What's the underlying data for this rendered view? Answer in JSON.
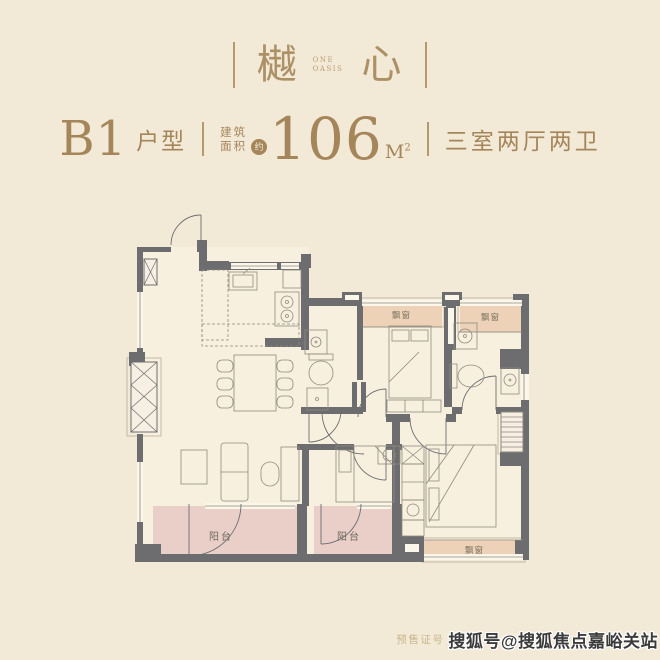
{
  "logo": {
    "char_left": "樾",
    "char_right": "心",
    "subtitle_line1": "ONE",
    "subtitle_line2": "OASIS"
  },
  "header": {
    "unit_code": "B1",
    "unit_type_label": "户型",
    "area_label_line1": "建筑",
    "area_label_line2": "面积",
    "approx_badge": "约",
    "area_value": "106",
    "area_unit": "M",
    "area_unit_exponent": "2",
    "room_summary": "三室两厅两卫"
  },
  "floorplan": {
    "balcony_label_left": "阳台",
    "balcony_label_middle": "阳台",
    "bay_window_label_top_middle": "飘窗",
    "bay_window_label_top_right": "飘窗",
    "bay_window_label_bottom_right": "飘窗"
  },
  "footer": {
    "presale_license_label": "预售证号",
    "watermark": "搜狐号@搜狐焦点嘉峪关站"
  },
  "colors": {
    "page_background": "#f3e9d7",
    "gold_text": "#a5855a",
    "wall_gray": "#6d6d70",
    "balcony_pink": "#eacfc9",
    "bay_window_tan": "#eed2b7",
    "floor_cream": "#f8f0df",
    "watermark_text": "#3b3b3b"
  }
}
